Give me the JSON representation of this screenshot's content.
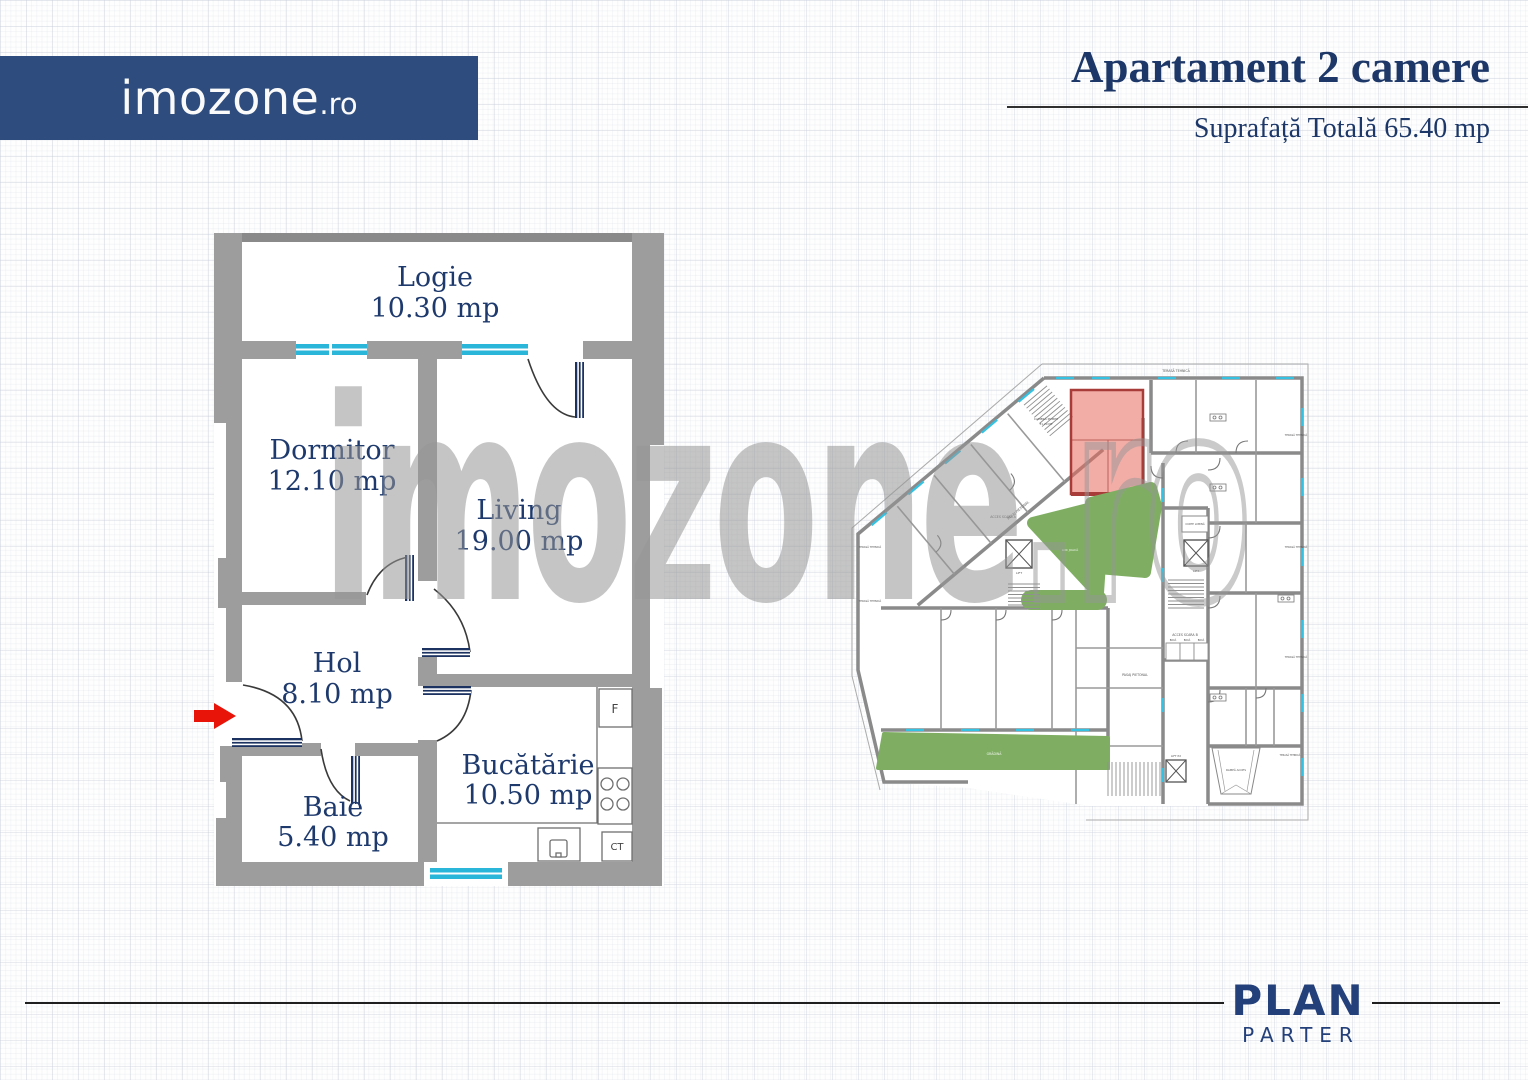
{
  "brand": {
    "name": "imozone",
    "tld": ".ro"
  },
  "header": {
    "title": "Apartament 2 camere",
    "subtitle": "Suprafață Totală 65.40 mp"
  },
  "watermark": {
    "name": "imozone",
    "tld": ".ro"
  },
  "apartment_plan": {
    "rooms": [
      {
        "name": "Logie",
        "area": "10.30 mp"
      },
      {
        "name": "Dormitor",
        "area": "12.10 mp"
      },
      {
        "name": "Living",
        "area": "19.00 mp"
      },
      {
        "name": "Hol",
        "area": "8.10 mp"
      },
      {
        "name": "Baie",
        "area": "5.40 mp"
      },
      {
        "name": "Bucătărie",
        "area": "10.50 mp"
      }
    ],
    "fixtures": {
      "fridge": "F",
      "boiler": "CT"
    },
    "colors": {
      "wall": "#9d9d9d",
      "wall_dark": "#8a8a8a",
      "window": "#29b6d9",
      "door": "#1c3260",
      "label": "#1e3a6d",
      "entrance_arrow": "#e81309"
    }
  },
  "site_plan": {
    "labels": {
      "terasa": "TERASĂ TEHNICĂ",
      "camera_pompe": "CAMERĂ POMPE",
      "camera_pompe_area": "31.20 MP",
      "pasaj": "PASAJ PIETONAL",
      "scara_a": "ACCES SCARA A",
      "scara_b": "ACCES SCARA B",
      "boxa": "BOXĂ",
      "curte": "CURTE LUMINĂ",
      "lift": "LIFT",
      "lift_p2": "LIFT P2",
      "rampa": "RAMPĂ ACCES",
      "gradina": "GRĂDINĂ",
      "loc_joaca": "LOC JOACĂ"
    },
    "colors": {
      "highlight": "#e76a5f",
      "highlight_border": "#a83c38",
      "green": "#7fae63",
      "wall": "#8a8a8a",
      "window": "#35c2e2"
    }
  },
  "footer": {
    "plan": "PLAN",
    "level": "PARTER"
  }
}
